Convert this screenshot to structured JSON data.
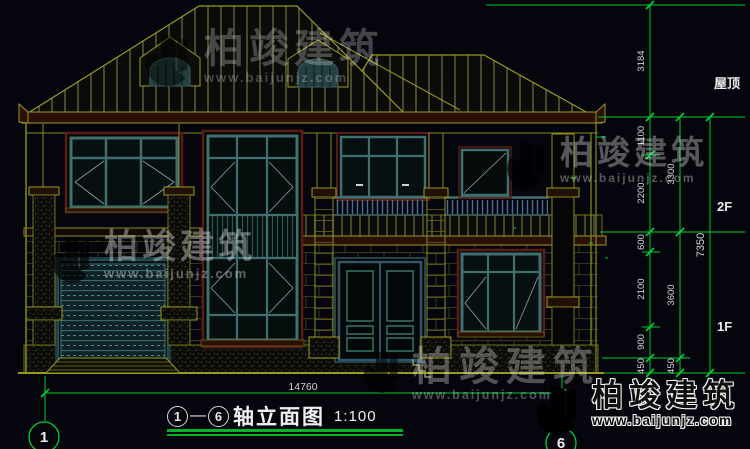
{
  "drawing": {
    "title": {
      "axis_start": "1",
      "axis_end": "6",
      "name": "轴立面图",
      "scale": "1:100"
    },
    "axis_bubbles": {
      "left": "1",
      "right": "6"
    },
    "dimensions": {
      "overall_width": "14760",
      "right_inner": [
        "3184",
        "1100",
        "2200",
        "600",
        "2100",
        "900",
        "450"
      ],
      "right_middle": [
        "3300",
        "3600",
        "450"
      ],
      "right_overall": "7350",
      "level_labels": {
        "roof": "屋顶",
        "second": "2F",
        "first": "1F"
      }
    }
  },
  "watermark": {
    "brand": "柏竣建筑",
    "url": "www.baijunjz.com"
  },
  "colors": {
    "background": "#05050d",
    "dim_green": "#00cc33",
    "line_olive": "#9a9a20",
    "frame_teal": "#3f6f6f",
    "surround_maroon": "#5a1c14",
    "railing_blue": "#4e6e96",
    "logo_blue": "#1a62b8",
    "logo_orange": "#f5a21d"
  }
}
